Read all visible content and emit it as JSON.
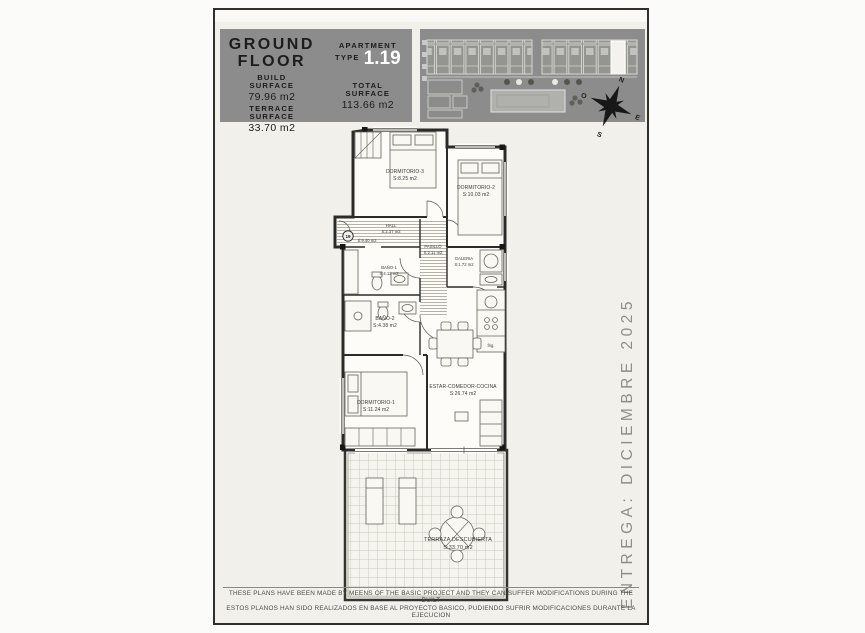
{
  "title_block": {
    "floor_l1": "GROUND",
    "floor_l2": "FLOOR",
    "build_l1": "BUILD",
    "build_l2": "SURFACE",
    "build_value": "79.96 m2",
    "terrace_l1": "TERRACE",
    "terrace_l2": "SURFACE",
    "terrace_value": "33.70 m2",
    "apartment_l1": "APARTMENT",
    "apartment_l2": "TYPE",
    "apartment_number": "1.19",
    "total_l1": "TOTAL",
    "total_l2": "SURFACE",
    "total_value": "113.66 m2"
  },
  "site_plan": {
    "compass": {
      "north": "N",
      "east": "E",
      "south": "S",
      "west": "O"
    }
  },
  "plan": {
    "unit_marker": "19",
    "porch_area": "S:9.40 m2",
    "kitchen_note": "frig.",
    "rooms": [
      {
        "name": "DORMITORIO-3",
        "area": "S:8.25 m2"
      },
      {
        "name": "DORMITORIO-2",
        "area": "S:10.03 m2"
      },
      {
        "name": "HALL",
        "area": "S:2.37 m2"
      },
      {
        "name": "PASILLO",
        "area": "S:2.11 m2"
      },
      {
        "name": "BAÑO-1",
        "area": "S:4.12 m2"
      },
      {
        "name": "BAÑO-2",
        "area": "S:4.38 m2"
      },
      {
        "name": "GALERIA",
        "area": "S:1.72 m2"
      },
      {
        "name": "DORMITORIO-1",
        "area": "S:11.24 m2"
      },
      {
        "name": "ESTAR-COMEDOR-COCINA",
        "area": "S:26.74 m2"
      },
      {
        "name": "TERRAZA DESCUBIERTA",
        "area": "S:33.70 m2"
      }
    ]
  },
  "delivery_note": "ENTREGA: DICIEMBRE 2025",
  "disclaimer": {
    "line1": "THESE PLANS HAVE BEEN MADE BY MEENS OF THE BASIC PROJECT AND THEY CAN SUFFER MODIFICATIONS DURING THE BUILT",
    "line2": "ESTOS PLANOS HAN SIDO REALIZADOS EN BASE AL PROYECTO BASICO, PUDIENDO SUFRIR MODIFICACIONES DURANTE LA EJECUCION"
  }
}
